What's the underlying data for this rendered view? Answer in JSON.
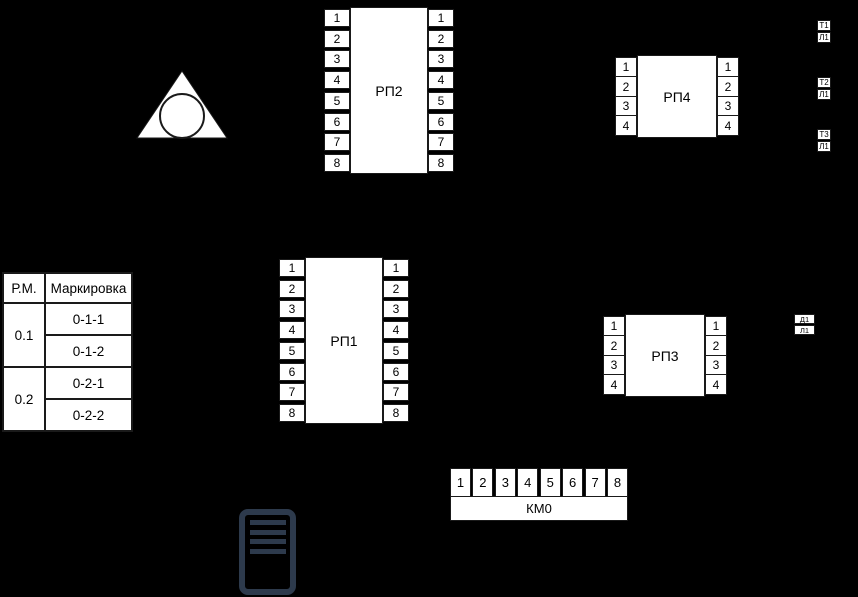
{
  "background_color": "#000000",
  "ink_color": "#1a1a1a",
  "panel_fill_color": "#ffffff",
  "server_icon_color": "#2d3a4c",
  "pbx_symbol": {
    "name": "triangle-with-inscribed-circle"
  },
  "panels": [
    {
      "id": "rp1",
      "label": "РП1",
      "pins_left": [
        "1",
        "2",
        "3",
        "4",
        "5",
        "6",
        "7",
        "8"
      ],
      "pins_right": [
        "1",
        "2",
        "3",
        "4",
        "5",
        "6",
        "7",
        "8"
      ]
    },
    {
      "id": "rp2",
      "label": "РП2",
      "pins_left": [
        "1",
        "2",
        "3",
        "4",
        "5",
        "6",
        "7",
        "8"
      ],
      "pins_right": [
        "1",
        "2",
        "3",
        "4",
        "5",
        "6",
        "7",
        "8"
      ]
    },
    {
      "id": "rp3",
      "label": "РП3",
      "pins_left": [
        "1",
        "2",
        "3",
        "4"
      ],
      "pins_right": [
        "1",
        "2",
        "3",
        "4"
      ]
    },
    {
      "id": "rp4",
      "label": "РП4",
      "pins_left": [
        "1",
        "2",
        "3",
        "4"
      ],
      "pins_right": [
        "1",
        "2",
        "3",
        "4"
      ]
    }
  ],
  "km0": {
    "label": "КМ0",
    "pins": [
      "1",
      "2",
      "3",
      "4",
      "5",
      "6",
      "7",
      "8"
    ]
  },
  "marking_table": {
    "headers": [
      "Р.М.",
      "Маркировка"
    ],
    "groups": [
      {
        "rm": "0.1",
        "markings": [
          "0-1-1",
          "0-1-2"
        ]
      },
      {
        "rm": "0.2",
        "markings": [
          "0-2-1",
          "0-2-2"
        ]
      }
    ]
  },
  "tags": [
    {
      "id": "t1",
      "top": "Т1",
      "bottom": "Л1"
    },
    {
      "id": "t2",
      "top": "Т2",
      "bottom": "Л1"
    },
    {
      "id": "t3",
      "top": "Т3",
      "bottom": "Л1"
    },
    {
      "id": "d1",
      "top": "Д1",
      "bottom": "Л1"
    }
  ]
}
